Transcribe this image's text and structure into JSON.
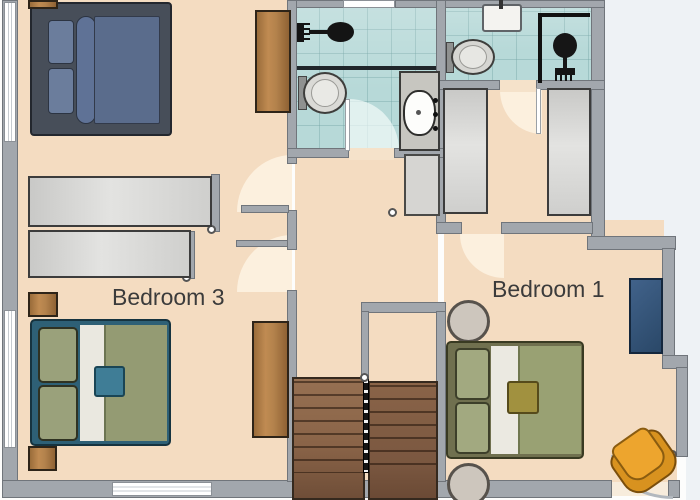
{
  "image_type": "residential-floor-plan-upper-storey",
  "labels": {
    "bedroom3": "Bedroom 3",
    "bedroom1": "Bedroom 1"
  },
  "palette": {
    "floor": "#f4dcc1",
    "wall": "#a2a7ad",
    "wall_edge": "#70757b",
    "bathroom_tile": "#b7d9d8",
    "wood": "#b3824c",
    "stair_brown": "#8a6348",
    "bed_navy_duvet": "#5a6c8c",
    "bed_navy_frame": "#474e59",
    "bed_teal_frame": "#2e6076",
    "bed_olive_duvet": "#99a173",
    "bed_olive_frame": "#70704f",
    "accent_cushion_teal": "#3f7d96",
    "accent_cushion_gold": "#a1913f",
    "armchair_orange": "#e8a12b",
    "desk_navy": "#3a5a7e",
    "door_arc": "#fcf0de",
    "outside": "#eef2f5",
    "text": "#3b3b3b"
  },
  "fixtures": [
    "double-bed-navy",
    "double-bed-teal-olive",
    "double-bed-olive",
    "wardrobe-sliding-gray-a",
    "wardrobe-sliding-gray-b",
    "wardrobe-gray-c",
    "wardrobe-gray-d",
    "wardrobe-wood",
    "sideboard-wood",
    "nightstand-wood",
    "shower",
    "toilet",
    "washbasin-vanity",
    "washbasin-wall",
    "shower-enclosure",
    "toilet-2",
    "staircase-two-flights",
    "hall-cabinet",
    "round-pouf",
    "desk-navy",
    "armchair-orange"
  ]
}
